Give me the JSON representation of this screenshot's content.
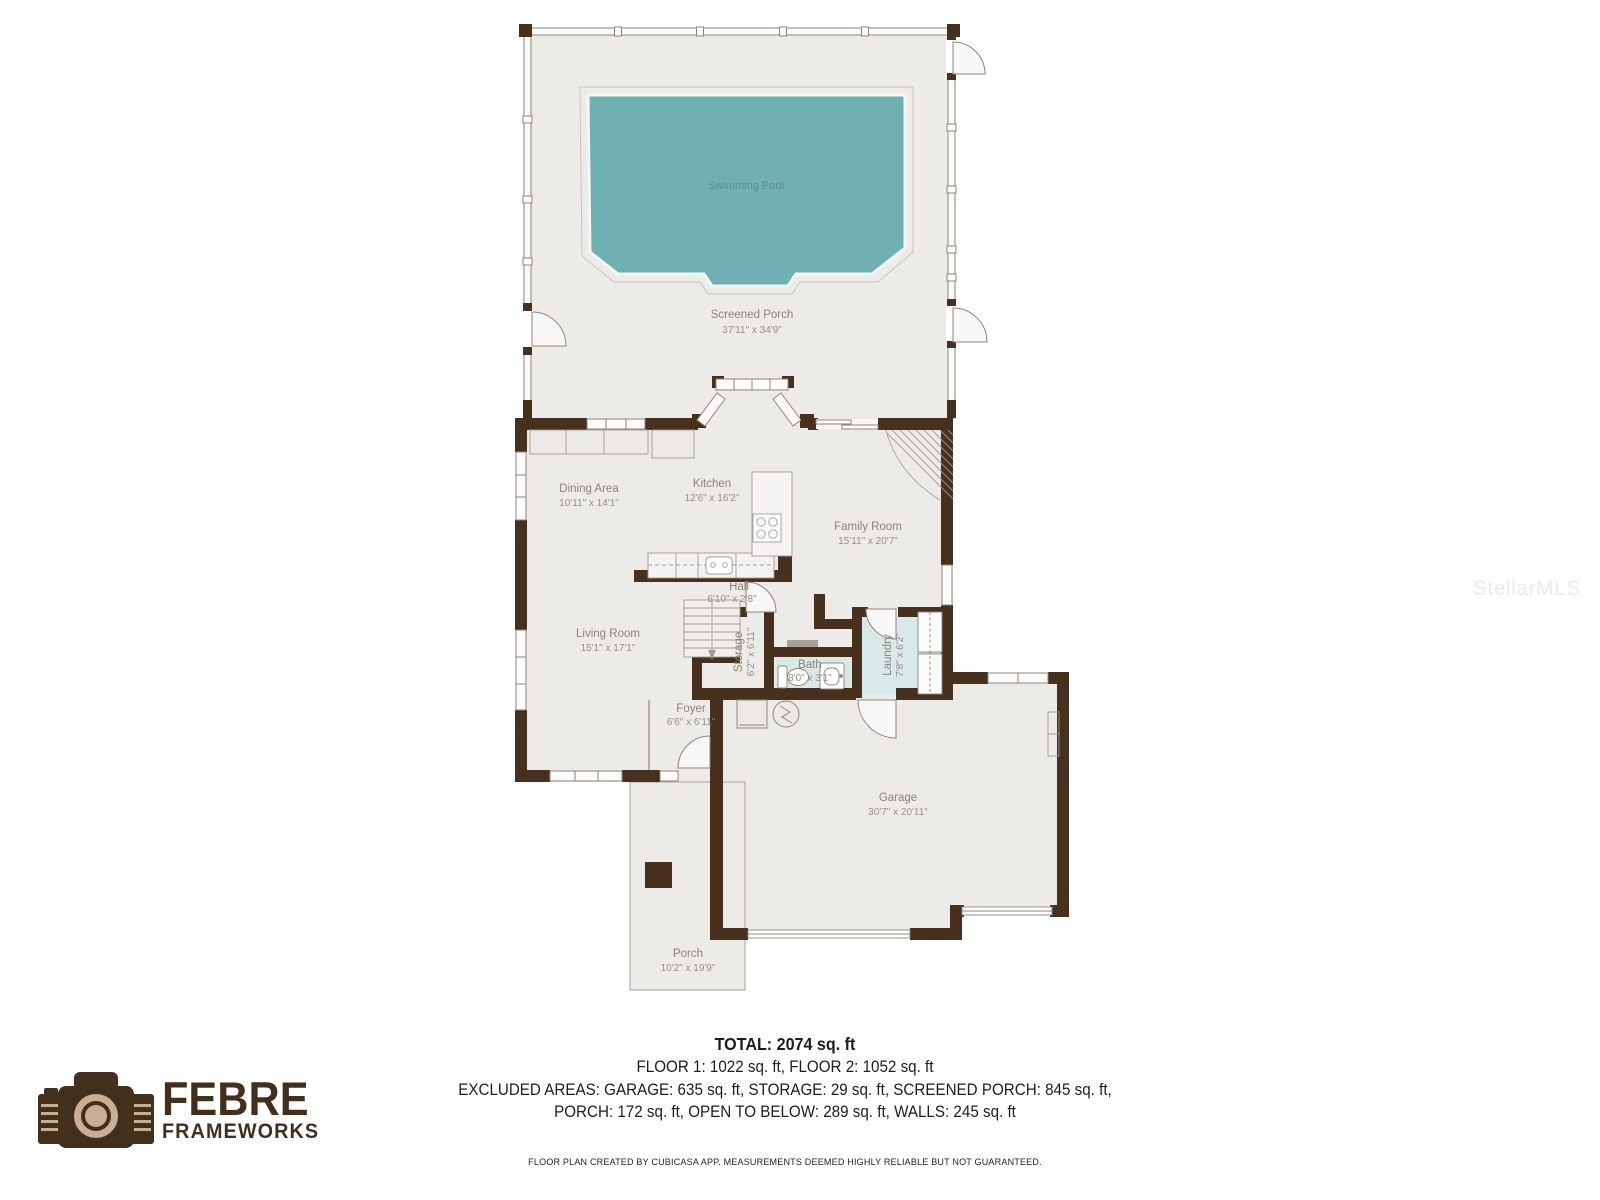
{
  "watermark": "StellarMLS",
  "logo": {
    "brand": "FEBRE",
    "sub": "FRAMEWORKS"
  },
  "rooms": {
    "swimming_pool": {
      "name": "Swimming Pool"
    },
    "screened_porch": {
      "name": "Screened Porch",
      "dims": "37'11\" x 34'9\""
    },
    "dining": {
      "name": "Dining Area",
      "dims": "10'11\" x 14'1\""
    },
    "kitchen": {
      "name": "Kitchen",
      "dims": "12'6\" x 16'2\""
    },
    "family": {
      "name": "Family Room",
      "dims": "15'11\" x 20'7\""
    },
    "hall": {
      "name": "Hall",
      "dims": "6'10\" x 2'8\""
    },
    "storage": {
      "name": "Storage",
      "dims": "6'2\" x 6'11\""
    },
    "bath": {
      "name": "Bath",
      "dims": "8'0\" x 3'1\""
    },
    "laundry": {
      "name": "Laundry",
      "dims": "7'8\" x 6'2\""
    },
    "living": {
      "name": "Living Room",
      "dims": "15'1\" x 17'1\""
    },
    "foyer": {
      "name": "Foyer",
      "dims": "6'6\" x 6'11\""
    },
    "garage": {
      "name": "Garage",
      "dims": "30'7\" x 20'11\""
    },
    "porch": {
      "name": "Porch",
      "dims": "10'2\" x 19'9\""
    }
  },
  "summary": {
    "total": "TOTAL: 2074 sq. ft",
    "floors": "FLOOR 1: 1022 sq. ft, FLOOR 2: 1052 sq. ft",
    "excluded_line1": "EXCLUDED AREAS: GARAGE: 635 sq. ft, STORAGE: 29 sq. ft, SCREENED PORCH: 845 sq. ft,",
    "excluded_line2": "PORCH: 172 sq. ft, OPEN TO BELOW: 289 sq. ft, WALLS: 245 sq. ft",
    "disclaimer": "FLOOR PLAN CREATED BY CUBICASA APP. MEASUREMENTS DEEMED HIGHLY RELIABLE BUT NOT GUARANTEED."
  },
  "icons": {
    "camera": "camera-icon",
    "toilet": "toilet-icon",
    "sink": "sink-icon",
    "stove": "stove-icon",
    "water_heater": "water-heater-icon",
    "stairs": "stairs-icon",
    "door_swing": "door-swing-arc"
  },
  "colors": {
    "wall": "#47301e",
    "floor": "#edebe8",
    "pool": "#6fb0b2",
    "wet_floor": "#d9e8e9",
    "label": "#8b8276",
    "thin_line": "#8d857a",
    "logo_brown": "#42301d",
    "logo_tan": "#c8ae94"
  }
}
